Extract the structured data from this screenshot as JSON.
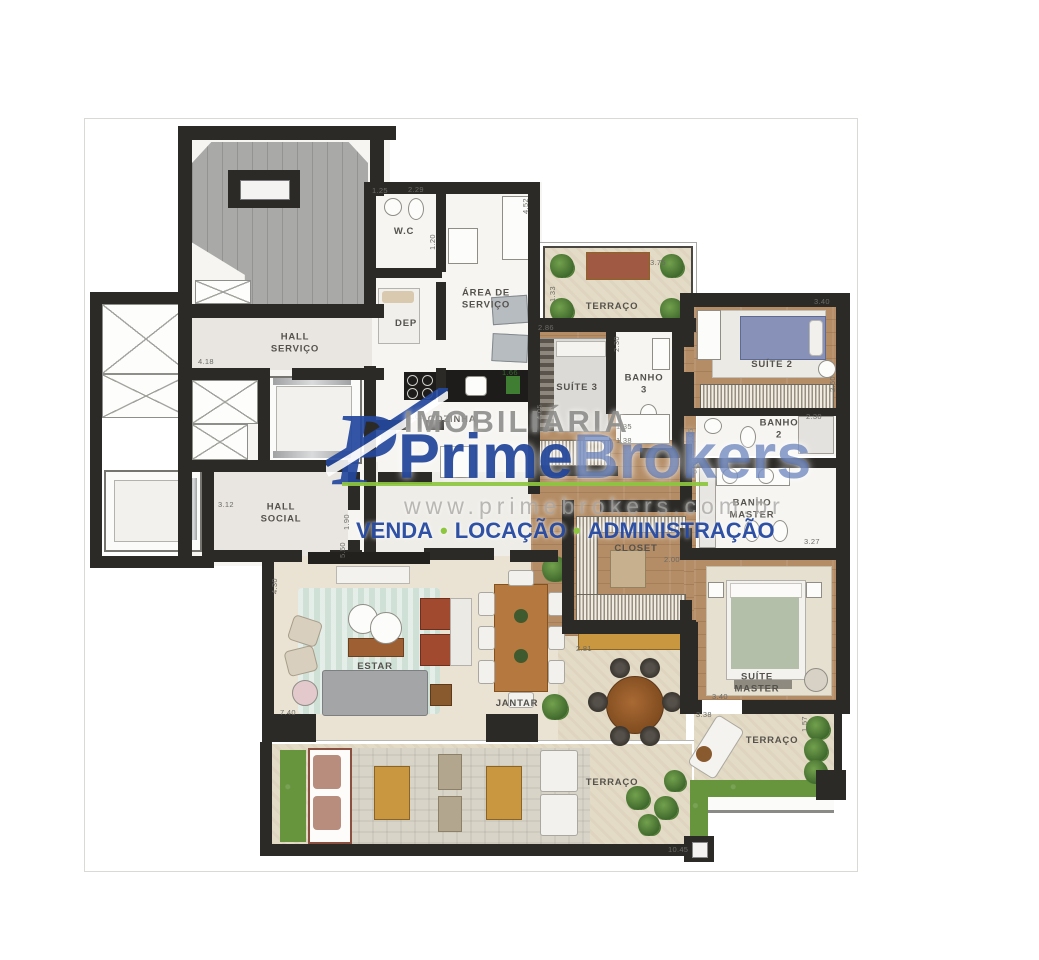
{
  "watermark": {
    "logo_letter": "P",
    "imobiliaria": "IMOBILIÁRIA",
    "brand_prime": "Prime",
    "brand_brokers": "Brokers",
    "website": "www.primebrokers.com.br",
    "tagline": {
      "venda": "VENDA",
      "locacao": "LOCAÇÃO",
      "administracao": "ADMINISTRAÇÃO",
      "separator": "•"
    },
    "colors": {
      "brand_blue": "#24489e",
      "brand_blue_light": "#4c6bb0",
      "brand_green": "#8dc63f",
      "gray": "#8a8a88"
    }
  },
  "plan": {
    "type": "apartment-floor-plan",
    "rooms": {
      "hall_servico": "HALL\nSERVIÇO",
      "hall_social": "HALL\nSOCIAL",
      "wc": "W.C",
      "dep": "DEP",
      "area_servico": "ÁREA DE\nSERVIÇO",
      "cozinha": "COZINHA",
      "terraco_top": "TERRAÇO",
      "suite_3": "SUÍTE 3",
      "banho_3": "BANHO\n3",
      "suite_2": "SUÍTE 2",
      "banho_2": "BANHO\n2",
      "banho_master": "BANHO\nMASTER",
      "closet": "CLOSET",
      "suite_master": "SUÍTE\nMASTER",
      "estar": "ESTAR",
      "jantar": "JANTAR",
      "terraco_bottom": "TERRAÇO",
      "terraco_master": "TERRAÇO"
    },
    "dims": [
      "4.18",
      "1.25",
      "2.29",
      "4.52",
      "1.20",
      "1.62",
      "2.86",
      "2.30",
      "3.75",
      "1.33",
      "3.40",
      "2.60",
      "2.30",
      "6.05",
      "3.27",
      "2.00",
      "1.35",
      "1.38",
      "4.05",
      "1.66",
      "3.12",
      "1.90",
      "4.30",
      "7.40",
      "5.50",
      "2.81",
      "3.40",
      "3.38",
      "1.57",
      "10.45",
      "6.90"
    ],
    "palette": {
      "wall": "#2c2a27",
      "wood_floor": "#b48d66",
      "terrace": "#e4dbc6",
      "grass": "#67953e",
      "stair": "#a9a9a7",
      "room": "#f6f5f2"
    }
  }
}
